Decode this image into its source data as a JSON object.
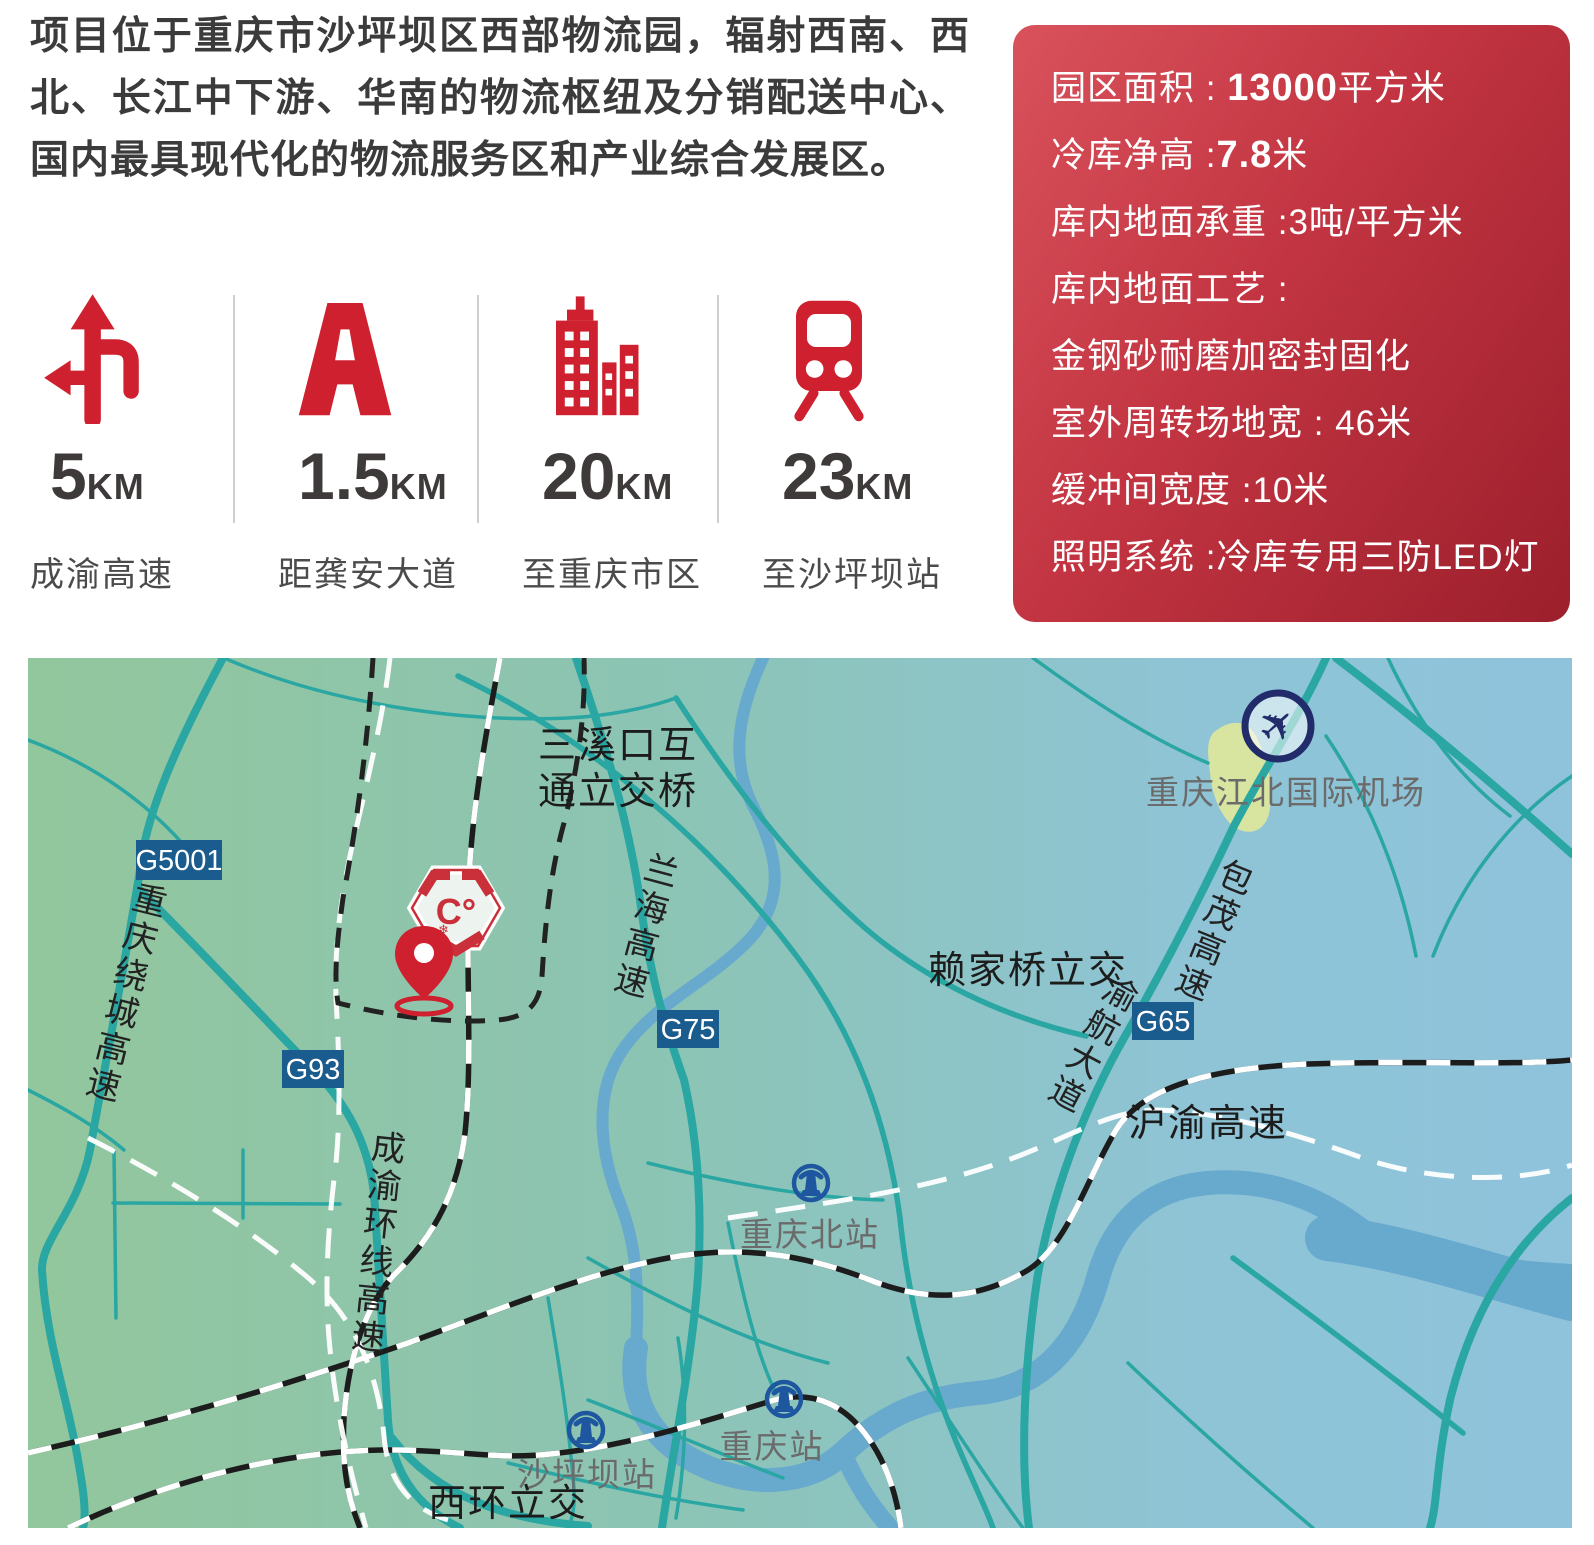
{
  "intro": {
    "text": "项目位于重庆市沙坪坝区西部物流园，辐射西南、西北、长江中下游、华南的物流枢纽及分销配送中心、国内最具现代化的物流服务区和产业综合发展区。"
  },
  "stats": [
    {
      "value": "5",
      "unit": "KM",
      "label": "成渝高速",
      "icon": "junction-arrows-icon"
    },
    {
      "value": "1.5",
      "unit": "KM",
      "label": "距龚安大道",
      "icon": "highway-icon"
    },
    {
      "value": "20",
      "unit": "KM",
      "label": "至重庆市区",
      "icon": "city-buildings-icon"
    },
    {
      "value": "23",
      "unit": "KM",
      "label": "至沙坪坝站",
      "icon": "train-icon"
    }
  ],
  "specs": {
    "rows": [
      {
        "prefix": "园区面积 : ",
        "strong": "13000",
        "suffix": "平方米"
      },
      {
        "prefix": "冷库净高 :",
        "strong": "7.8",
        "suffix": "米"
      },
      {
        "prefix": "库内地面承重 :3吨/平方米",
        "strong": "",
        "suffix": ""
      },
      {
        "prefix": "库内地面工艺 : ",
        "strong": "",
        "suffix": ""
      },
      {
        "prefix": "金钢砂耐磨加密封固化",
        "strong": "",
        "suffix": ""
      },
      {
        "prefix": "室外周转场地宽 : 46米",
        "strong": "",
        "suffix": ""
      },
      {
        "prefix": "缓冲间宽度 :10米",
        "strong": "",
        "suffix": ""
      },
      {
        "prefix": "照明系统 :冷库专用三防LED灯",
        "strong": "",
        "suffix": ""
      }
    ]
  },
  "map": {
    "badges": [
      {
        "label": "G5001"
      },
      {
        "label": "G93"
      },
      {
        "label": "G75"
      },
      {
        "label": "G65"
      }
    ],
    "labels": {
      "sanxikou1": "三溪口互",
      "sanxikou2": "通立交桥",
      "lanhai": "兰海高速",
      "raocheng_left": "重庆绕城高速",
      "chengyu_ring": "成渝环线高速",
      "baomao": "包茂高速",
      "yuhang": "渝航大道",
      "laijiaqiao": "赖家桥立交",
      "huyu": "沪渝高速",
      "airport": "重庆江北国际机场",
      "cq_north_station": "重庆北站",
      "cq_station": "重庆站",
      "shapingba_station": "沙坪坝站",
      "xihuan": "西环立交",
      "logo_mark": "C°",
      "plane_glyph": "✈"
    },
    "colors": {
      "accent_red": "#ce202e",
      "road_teal": "#2aa6a3",
      "river_blue": "#68a9ce",
      "badge_blue": "#1b5c8e",
      "station_blue": "#1e56a0",
      "plane_navy": "#232c6b",
      "map_green": "#92c69c",
      "map_blue": "#8fc3dc"
    }
  }
}
